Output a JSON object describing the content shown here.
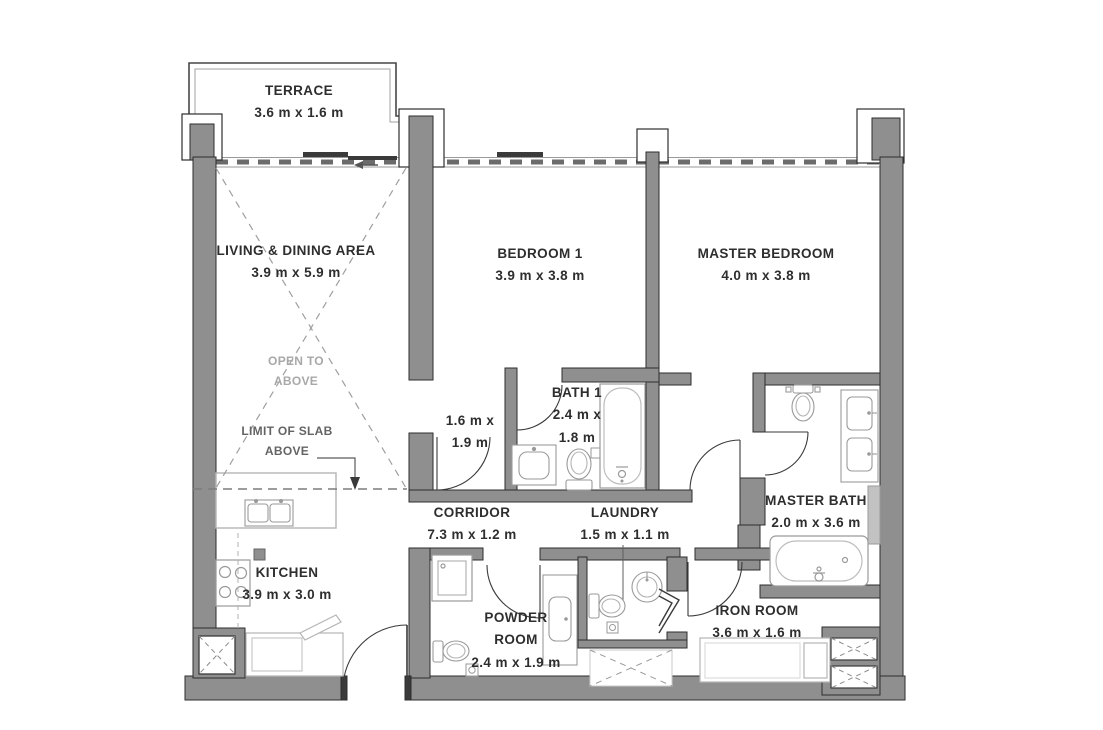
{
  "rooms": {
    "terrace": {
      "name": "TERRACE",
      "dims": "3.6 m x 1.6 m"
    },
    "living": {
      "name": "LIVING & DINING AREA",
      "dims": "3.9 m x 5.9 m"
    },
    "bedroom1": {
      "name": "BEDROOM 1",
      "dims": "3.9 m x 3.8 m"
    },
    "master_bedroom": {
      "name": "MASTER BEDROOM",
      "dims": "4.0 m x 3.8 m"
    },
    "closet": {
      "dims_line1": "1.6 m x",
      "dims_line2": "1.9 m"
    },
    "bath1": {
      "name": "BATH 1",
      "dims_line1": "2.4 m x",
      "dims_line2": "1.8 m"
    },
    "corridor": {
      "name": "CORRIDOR",
      "dims": "7.3 m x 1.2 m"
    },
    "laundry": {
      "name": "LAUNDRY",
      "dims": "1.5 m x 1.1 m"
    },
    "master_bath": {
      "name": "MASTER BATH",
      "dims": "2.0 m x 3.6 m"
    },
    "kitchen": {
      "name": "KITCHEN",
      "dims": "3.9 m x 3.0 m"
    },
    "powder_room": {
      "name_line1": "POWDER",
      "name_line2": "ROOM",
      "dims": "2.4 m x 1.9 m"
    },
    "iron_room": {
      "name": "IRON ROOM",
      "dims": "3.6 m x 1.6 m"
    }
  },
  "annotations": {
    "open_to_above_line1": "OPEN TO",
    "open_to_above_line2": "ABOVE",
    "limit_of_slab_line1": "LIMIT OF SLAB",
    "limit_of_slab_line2": "ABOVE"
  },
  "colors": {
    "wall_fill": "#8f8f8f",
    "wall_outline": "#2e2e2e",
    "label_text": "#2e2e2e",
    "muted_text": "#a8a8a8",
    "fixture_line": "#9b9b9b",
    "background": "#ffffff"
  }
}
